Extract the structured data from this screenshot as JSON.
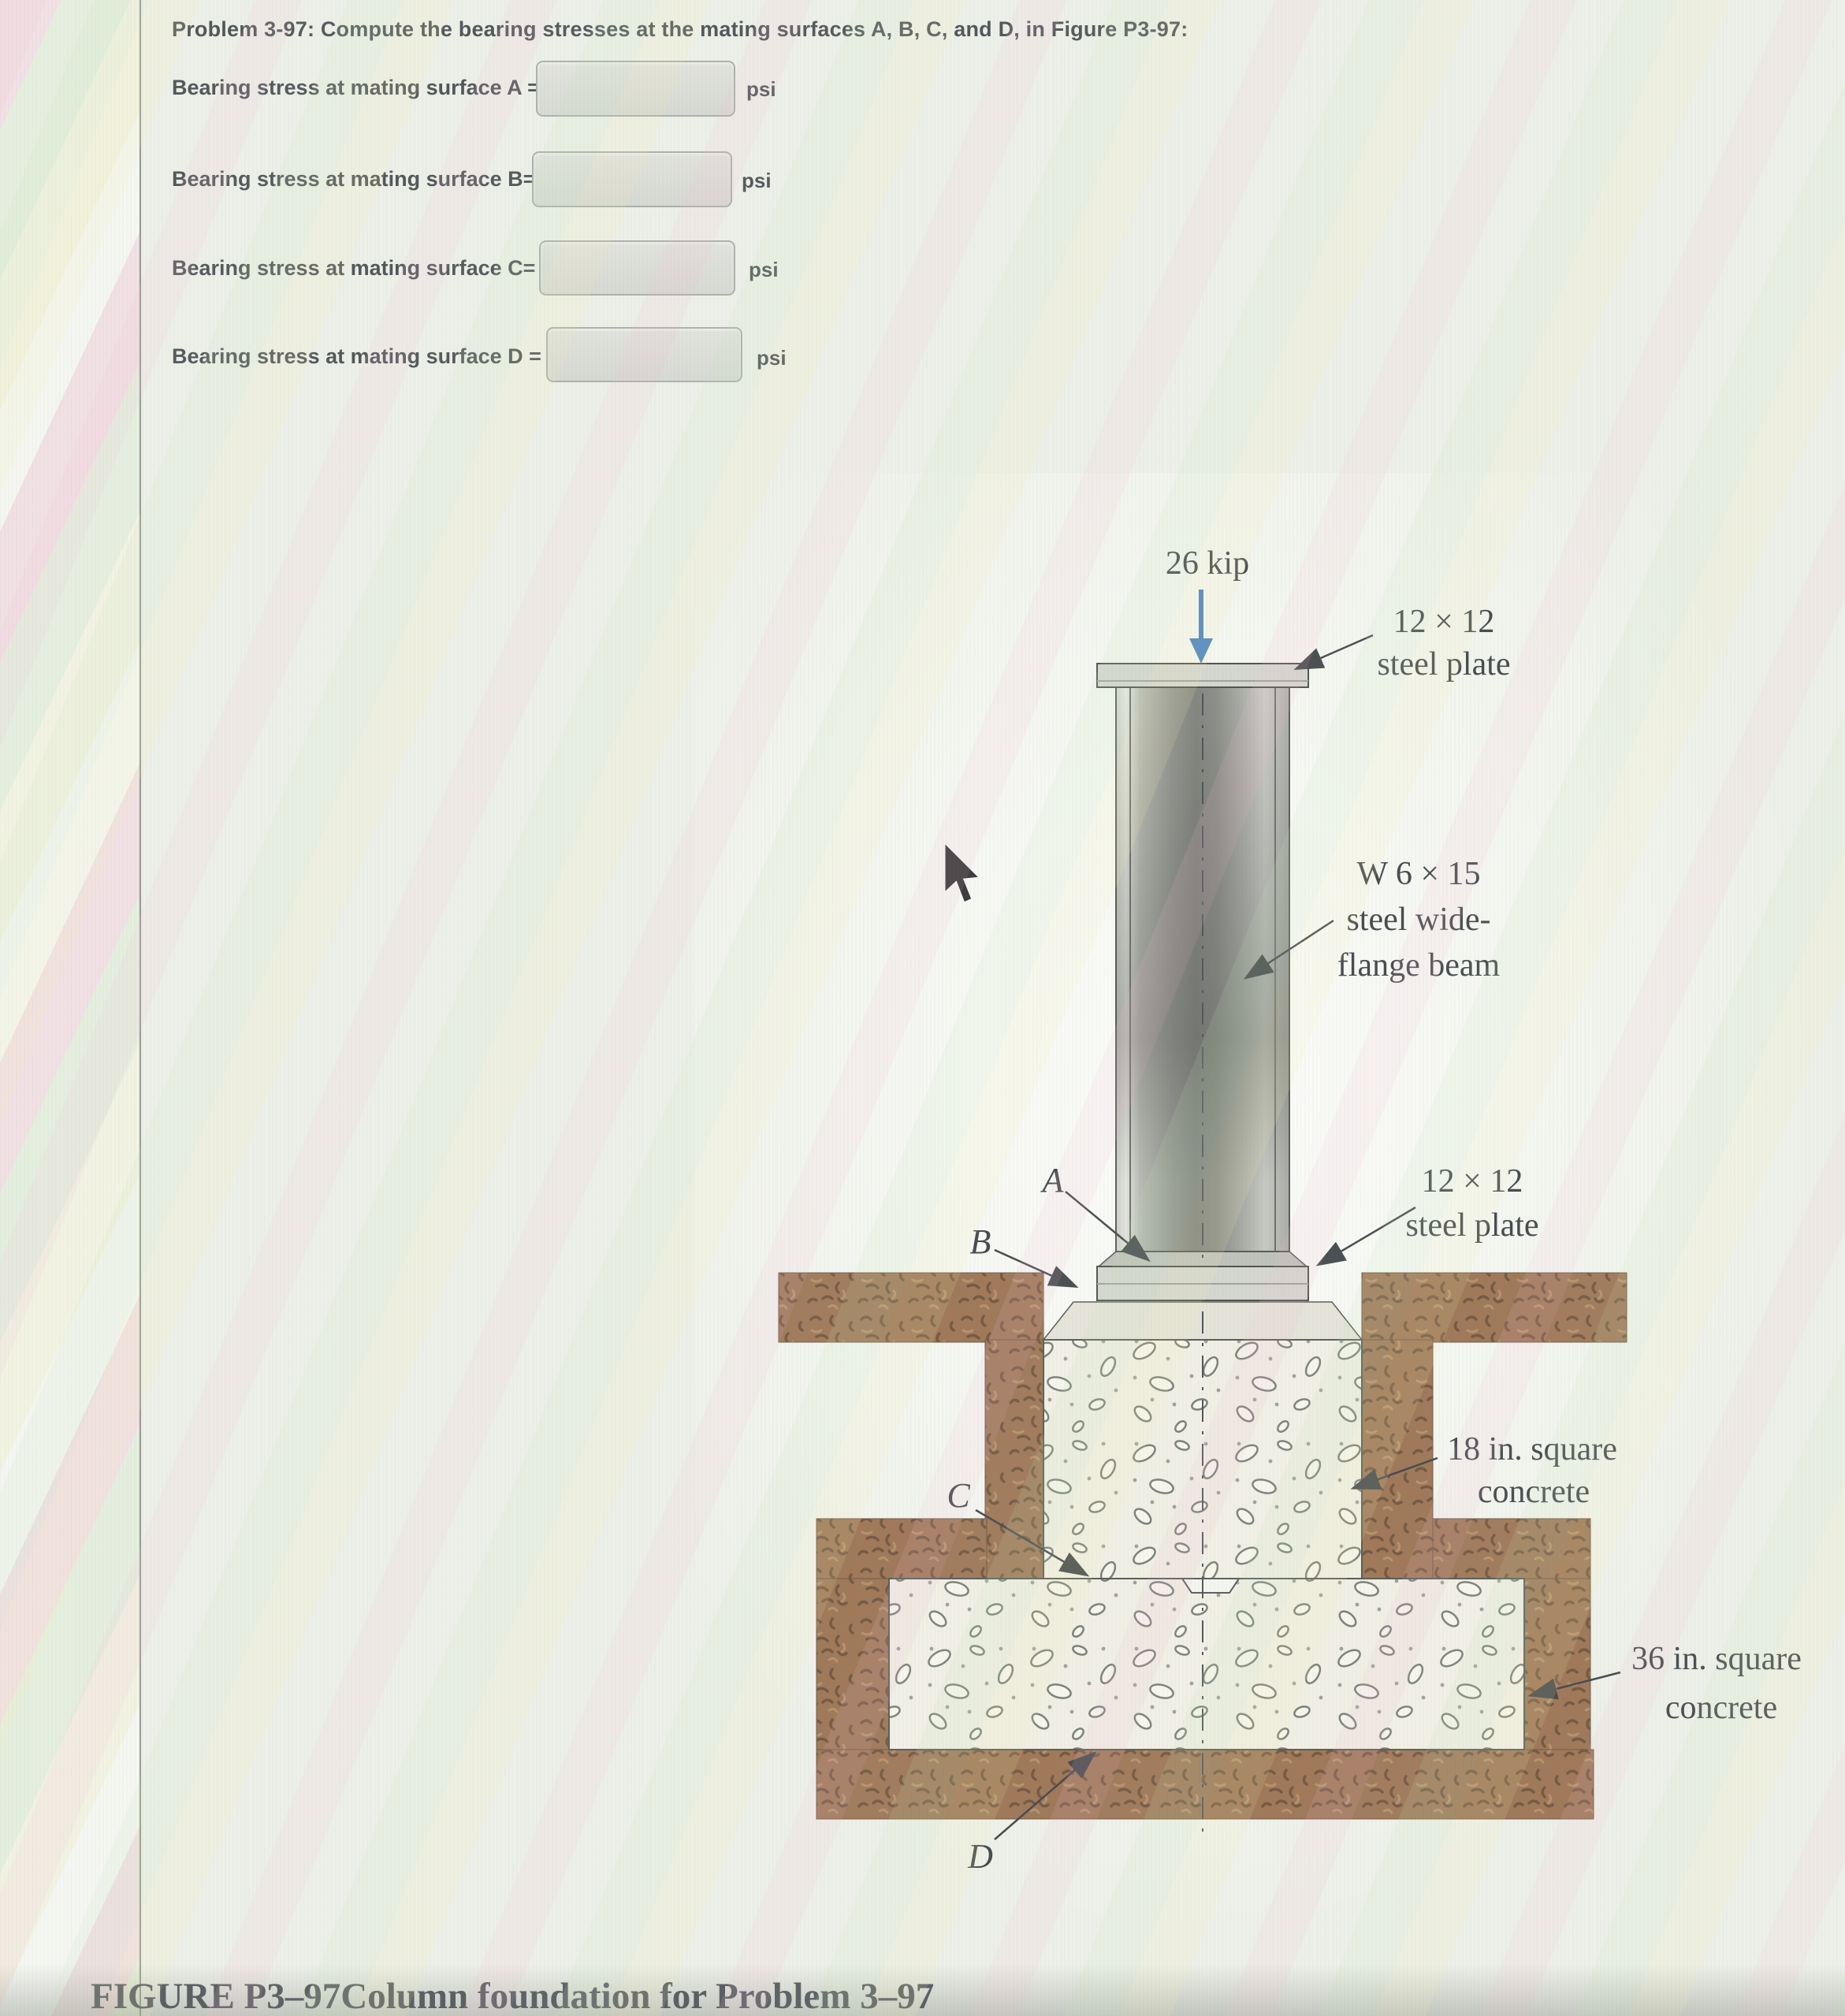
{
  "page": {
    "title": "Problem 3-97: Compute the bearing stresses at the mating surfaces A, B, C, and D, in Figure P3-97:",
    "rows": [
      {
        "label": "Bearing stress at mating surface A =",
        "value": "",
        "unit": "psi"
      },
      {
        "label": "Bearing stress at mating surface B=",
        "value": "",
        "unit": "psi"
      },
      {
        "label": "Bearing stress at mating surface C=",
        "value": "",
        "unit": "psi"
      },
      {
        "label": "Bearing stress at mating surface D =",
        "value": "",
        "unit": "psi"
      }
    ],
    "caption": {
      "figure_label": "FIGURE P3–97",
      "text": "Column foundation for Problem 3–97"
    }
  },
  "figure": {
    "load_label": "26 kip",
    "top_plate_label": [
      "12 × 12",
      "steel plate"
    ],
    "beam_label": [
      "W 6 × 15",
      "steel wide-",
      "flange beam"
    ],
    "bottom_plate_label": [
      "12 × 12",
      "steel plate"
    ],
    "pedestal_label": [
      "18 in. square",
      "concrete"
    ],
    "footing_label": [
      "36 in. square",
      "concrete"
    ],
    "points": {
      "a": "A",
      "b": "B",
      "c": "C",
      "d": "D"
    },
    "colors": {
      "arrow_blue": "#2a6db5",
      "soil_brown": "#8d5f3a",
      "soil_speckle": "#5c3a1f",
      "concrete": "#eeece0",
      "aggregate_outline": "#646a60",
      "steel_dark": "#6f716c",
      "plate_gray": "#cdcfc7",
      "line_dark": "#3a3d37"
    }
  }
}
